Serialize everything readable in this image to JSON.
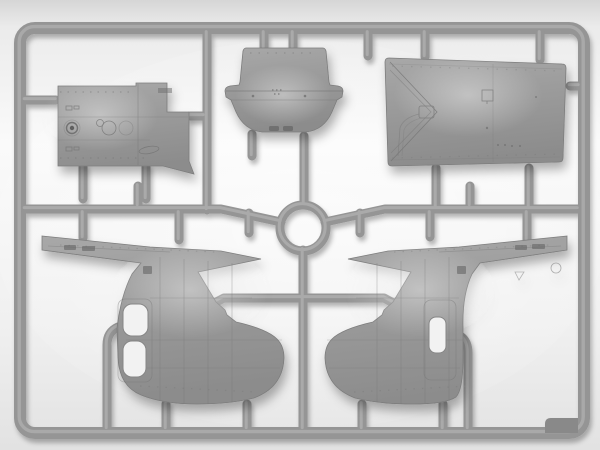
{
  "image": {
    "kind": "photograph",
    "subject": "Injection-molded gray styrene model-kit sprue (runner frame) holding helicopter fuselage parts on a white studio backdrop"
  },
  "colors": {
    "backdrop_top": "#d6d6d6",
    "backdrop_high": "#ebebeb",
    "backdrop_mid": "#fafafa",
    "backdrop_low": "#f0f0f0",
    "backdrop_bottom": "#e2e2e2",
    "glow": "#ffffff",
    "plastic": "#959595",
    "plastic_light": "#aeaeae",
    "plastic_dark": "#898989",
    "part_top": "#a8a8a8",
    "part_mid": "#9b9b9b",
    "part_bottom": "#8c8c8c",
    "part_edge": "#7d7d7d",
    "panel_line": "#737373",
    "recess": "#5f5f5f",
    "window_fill": "#f2f2f2"
  },
  "sprue": {
    "frame": "rounded rectangular outer runner frame",
    "hub": "circular runner ring at sprue center",
    "gate_tab": "thick molded tab in bottom-right inner corner",
    "material": "gray styrene plastic",
    "part_count": 5
  },
  "parts": [
    {
      "id": "floor-panel",
      "position": "top-left",
      "desc": "rectangular cabin panel with round fitting, keyhole fitting and access oval"
    },
    {
      "id": "nose-cowling",
      "position": "top-center",
      "desc": "rounded nose / engine cowling section with flared belt band and two lower vents"
    },
    {
      "id": "roof-panel",
      "position": "top-right",
      "desc": "large tapered roof deck panel with chevron panel lines and small hatch"
    },
    {
      "id": "fuselage-half-left",
      "position": "bottom-left",
      "desc": "fuselage half with tail boom pointing left, rounded belly and two door windows"
    },
    {
      "id": "fuselage-half-right",
      "position": "bottom-right",
      "desc": "mirrored fuselage half with tail boom pointing right, rounded belly and one door window"
    }
  ]
}
